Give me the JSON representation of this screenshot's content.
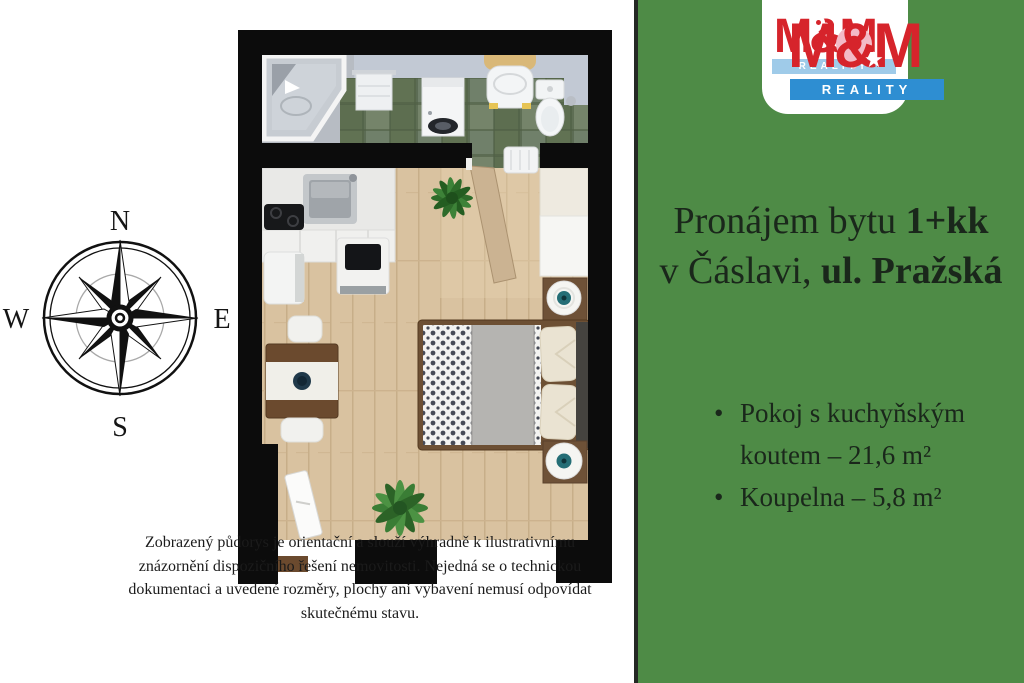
{
  "page": {
    "left_background": "#ffffff",
    "right_background": "#4e8b46",
    "divider_color": "#242824"
  },
  "logo": {
    "back": {
      "brand": "M&M",
      "reality": "REALITY"
    },
    "front": {
      "brand": "M&M",
      "reality": "REALITY",
      "star": "★"
    },
    "colors": {
      "red": "#d6242b",
      "blue": "#2e8ed2",
      "light_blue_strip": "#9fcbe9",
      "pin_pink": "#f3bbc7",
      "card_background": "#ffffff"
    }
  },
  "listing": {
    "title": {
      "line1_regular": "Pronájem bytu",
      "line1_bold": "1+kk",
      "line2_regular": "v Čáslavi,",
      "line2_bold": "ul. Pražská"
    },
    "features": [
      "Pokoj s kuchyňským koutem – 21,6 m²",
      "Koupelna – 5,8 m²"
    ]
  },
  "compass": {
    "north": "N",
    "south": "S",
    "east": "E",
    "west": "W"
  },
  "disclaimer": {
    "line1": "Zobrazený půdorys je orientační a slouží výhradně k ilustrativnímu",
    "line2": "znázornění dispozičního řešení nemovitosti. Nejedná se o technickou",
    "line3": "dokumentaci a uvedené rozměry, plochy ani vybavení nemusí odpovídat",
    "line4": "skutečnému stavu."
  },
  "floorplan": {
    "rooms": [
      {
        "name": "Pokoj s kuchyňským koutem",
        "area_m2": "21,6"
      },
      {
        "name": "Koupelna",
        "area_m2": "5,8"
      }
    ]
  }
}
